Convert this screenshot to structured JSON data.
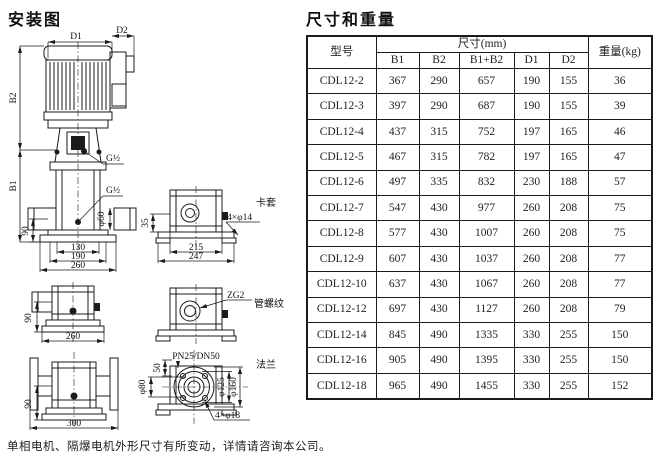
{
  "titles": {
    "left": "安装图",
    "right": "尺寸和重量"
  },
  "footnote": "单相电机、隔爆电机外形尺寸有所变动，详情请咨询本公司。",
  "diagram": {
    "main": {
      "d1": "D1",
      "d2": "D2",
      "b1": "B1",
      "b2": "B2",
      "g1": "G½",
      "g2": "G½",
      "phi60": "φ60",
      "dim90": "90",
      "dim130": "130",
      "dim190": "190",
      "dim260": "260"
    },
    "clamp": {
      "name": "卡套",
      "dim35": "35",
      "holes": "4×φ14",
      "dim215": "215",
      "dim247": "247"
    },
    "thread": {
      "name": "管螺纹",
      "conn": "ZG2"
    },
    "flange": {
      "name": "法兰",
      "conn": "PN25/DN50",
      "dim50": "50",
      "phi80": "φ80",
      "phi125": "φ125",
      "phi160": "φ160",
      "holes": "4×φ18"
    },
    "side_b": {
      "dim90": "90",
      "dim260": "260"
    },
    "side_c": {
      "dim90": "90",
      "dim300": "300"
    }
  },
  "table": {
    "col_model": "型号",
    "col_size": "尺寸(mm)",
    "col_weight": "重量(kg)",
    "size_cols": [
      "B1",
      "B2",
      "B1+B2",
      "D1",
      "D2"
    ],
    "rows": [
      [
        "CDL12-2",
        367,
        290,
        657,
        190,
        155,
        36
      ],
      [
        "CDL12-3",
        397,
        290,
        687,
        190,
        155,
        39
      ],
      [
        "CDL12-4",
        437,
        315,
        752,
        197,
        165,
        46
      ],
      [
        "CDL12-5",
        467,
        315,
        782,
        197,
        165,
        47
      ],
      [
        "CDL12-6",
        497,
        335,
        832,
        230,
        188,
        57
      ],
      [
        "CDL12-7",
        547,
        430,
        977,
        260,
        208,
        75
      ],
      [
        "CDL12-8",
        577,
        430,
        1007,
        260,
        208,
        75
      ],
      [
        "CDL12-9",
        607,
        430,
        1037,
        260,
        208,
        77
      ],
      [
        "CDL12-10",
        637,
        430,
        1067,
        260,
        208,
        77
      ],
      [
        "CDL12-12",
        697,
        430,
        1127,
        260,
        208,
        79
      ],
      [
        "CDL12-14",
        845,
        490,
        1335,
        330,
        255,
        150
      ],
      [
        "CDL12-16",
        905,
        490,
        1395,
        330,
        255,
        150
      ],
      [
        "CDL12-18",
        965,
        490,
        1455,
        330,
        255,
        152
      ]
    ]
  }
}
